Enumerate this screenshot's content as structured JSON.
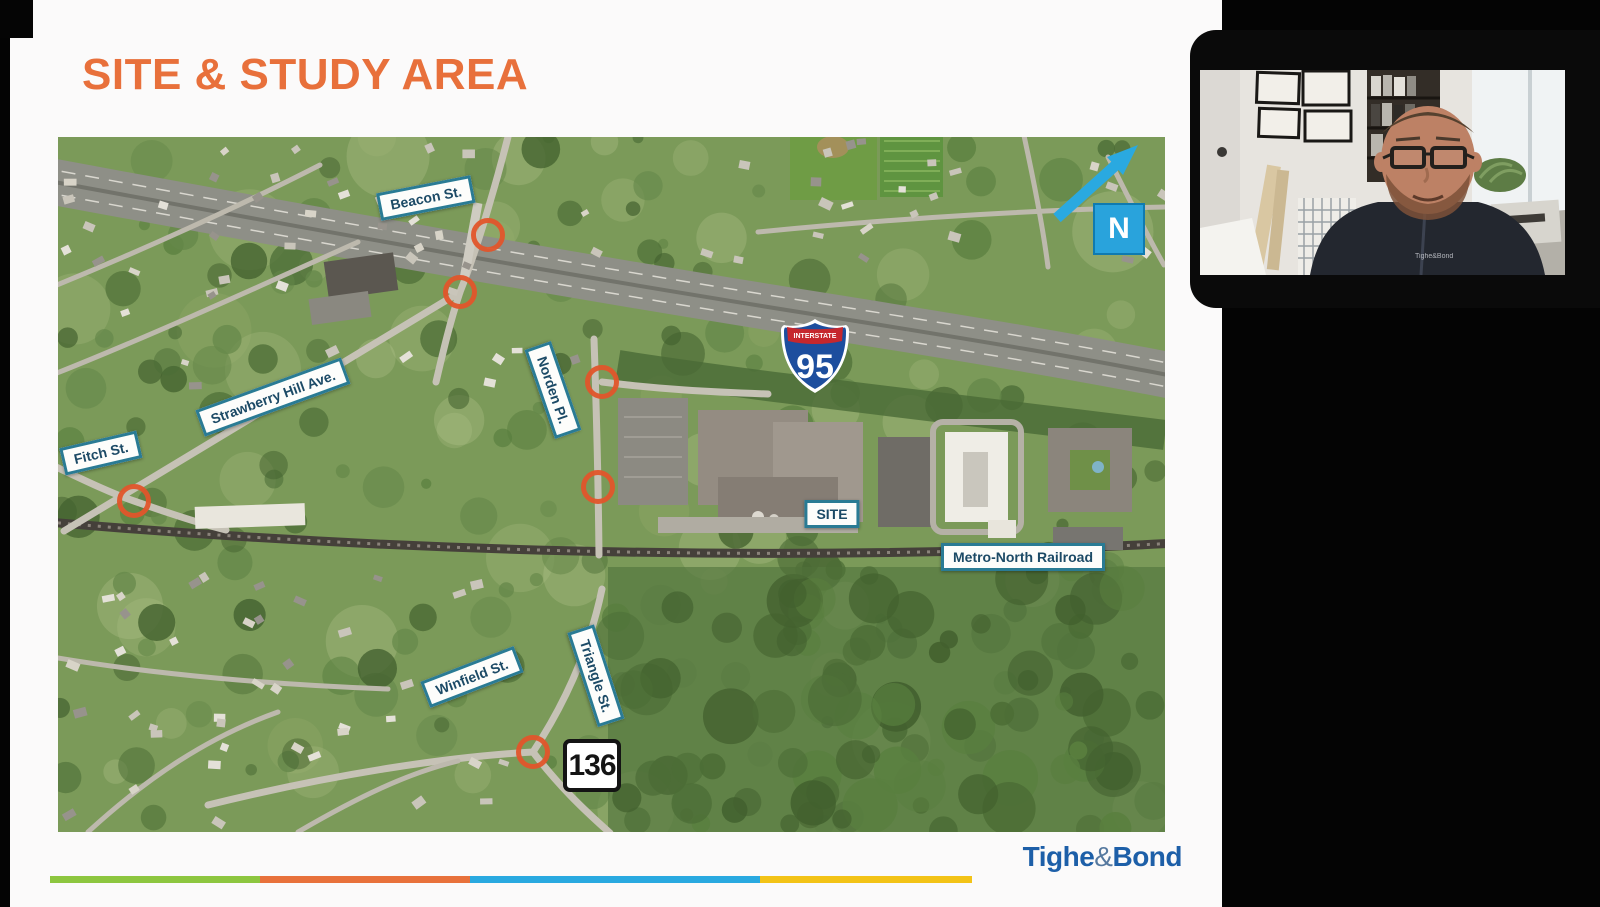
{
  "slide": {
    "title": "SITE & STUDY AREA",
    "title_color": "#e8703b"
  },
  "map": {
    "north_indicator": {
      "label": "N",
      "color": "#29a3dc"
    },
    "interstate_shield": {
      "banner": "INTERSTATE",
      "number": "95"
    },
    "route_shield": {
      "number": "136"
    },
    "marker_color": "#e2552b",
    "street_labels": [
      {
        "text": "Beacon St.",
        "x": 368,
        "y": 61,
        "rotation": -11
      },
      {
        "text": "Strawberry Hill Ave.",
        "x": 215,
        "y": 260,
        "rotation": -20
      },
      {
        "text": "Fitch St.",
        "x": 43,
        "y": 316,
        "rotation": -13
      },
      {
        "text": "Norden Pl.",
        "x": 495,
        "y": 253,
        "rotation": 71
      },
      {
        "text": "SITE",
        "x": 774,
        "y": 377,
        "rotation": 0
      },
      {
        "text": "Metro-North Railroad",
        "x": 965,
        "y": 420,
        "rotation": 0
      },
      {
        "text": "Winfield St.",
        "x": 414,
        "y": 540,
        "rotation": -21
      },
      {
        "text": "Triangle St.",
        "x": 538,
        "y": 539,
        "rotation": 72
      }
    ],
    "intersection_markers": [
      {
        "x": 430,
        "y": 98
      },
      {
        "x": 402,
        "y": 155
      },
      {
        "x": 544,
        "y": 245
      },
      {
        "x": 540,
        "y": 350
      },
      {
        "x": 76,
        "y": 364
      },
      {
        "x": 475,
        "y": 615
      }
    ]
  },
  "webcam": {
    "jacket_logo": "Tighe&Bond"
  },
  "footer": {
    "stripe": [
      {
        "color": "#8dc63f",
        "width": 210
      },
      {
        "color": "#e8713b",
        "width": 210
      },
      {
        "color": "#29a9e0",
        "width": 290
      },
      {
        "color": "#f3c317",
        "width": 212
      }
    ],
    "logo": {
      "tighe": "Tighe",
      "amp": "&",
      "bond": "Bond"
    }
  }
}
